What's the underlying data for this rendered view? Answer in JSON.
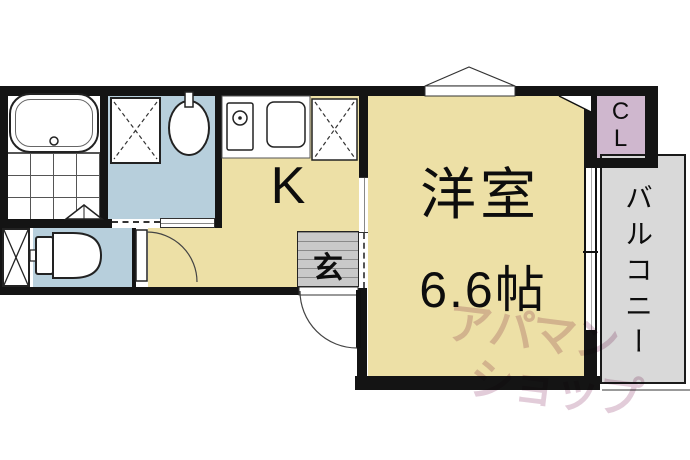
{
  "floorplan": {
    "title": "apartment-floor-plan",
    "rooms": {
      "kitchen": {
        "label": "K"
      },
      "living": {
        "name": "洋室",
        "size": "6.6帖"
      },
      "entrance": {
        "label": "玄"
      },
      "closet": {
        "label": "CL",
        "letters": [
          "C",
          "L"
        ]
      },
      "balcony": {
        "label": "バルコニー"
      }
    },
    "fixtures": {
      "bathtub": "bathtub",
      "washing_machine": "washing-machine-space",
      "wash_basin": "wash-basin",
      "toilet": "toilet",
      "pipe_space": "pipe-space",
      "stove": "stove-burner",
      "kitchen_sink": "kitchen-sink",
      "refrigerator": "refrigerator-space",
      "bay_window": "bay-window"
    },
    "watermark": {
      "text": "アパマンショップ",
      "line1": "アパマン",
      "line2": "ショップ"
    },
    "colors": {
      "room_floor": "#EDE0A6",
      "wet_area": "#B7CFDC",
      "balcony": "#D9D9D9",
      "closet": "#CFB7CE",
      "entrance_floor": "#C9C9C9",
      "wall": "#141414",
      "watermark": "#E2CCD9"
    }
  }
}
